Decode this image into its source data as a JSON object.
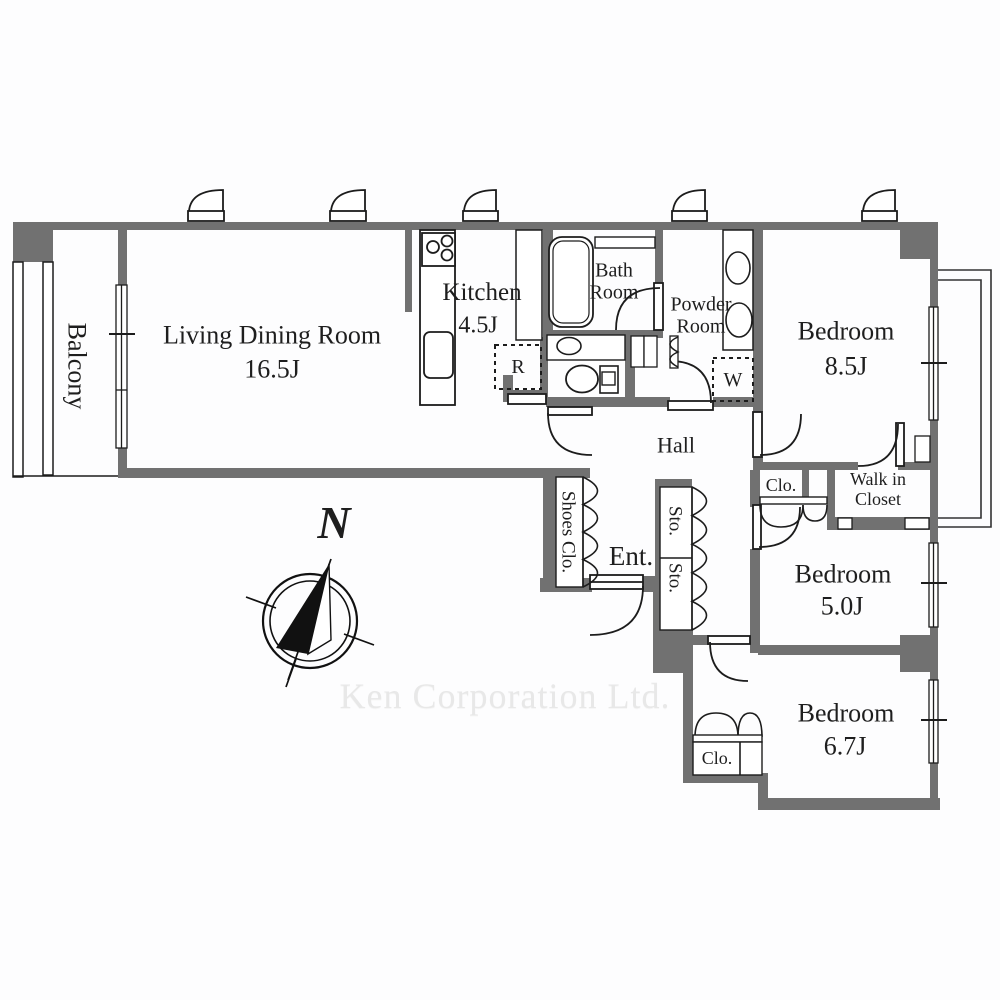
{
  "colors": {
    "wall": "#717171",
    "line": "#1c1c1c",
    "background": "#fdfdfe",
    "watermark_text": "#e8e8e8"
  },
  "rooms": {
    "balcony": {
      "label": "Balcony"
    },
    "living_dining": {
      "label": "Living Dining Room",
      "size": "16.5J"
    },
    "kitchen": {
      "label": "Kitchen",
      "size": "4.5J"
    },
    "bath": {
      "label": "Bath Room"
    },
    "powder": {
      "label": "Powder Room"
    },
    "bedroom_1": {
      "label": "Bedroom",
      "size": "8.5J"
    },
    "hall": {
      "label": "Hall"
    },
    "entrance": {
      "label": "Ent."
    },
    "shoes_closet": {
      "label": "Shoes Clo."
    },
    "storage_1": {
      "label": "Sto."
    },
    "storage_2": {
      "label": "Sto."
    },
    "closet_1": {
      "label": "Clo."
    },
    "walk_in_closet": {
      "label": "Walk in Closet"
    },
    "bedroom_2": {
      "label": "Bedroom",
      "size": "5.0J"
    },
    "bedroom_3": {
      "label": "Bedroom",
      "size": "6.7J"
    },
    "closet_2": {
      "label": "Clo."
    }
  },
  "fixtures": {
    "refrigerator": {
      "label": "R"
    },
    "washing_machine": {
      "label": "W"
    }
  },
  "compass": {
    "label": "N"
  },
  "watermark": {
    "text": "Ken Corporation Ltd."
  }
}
